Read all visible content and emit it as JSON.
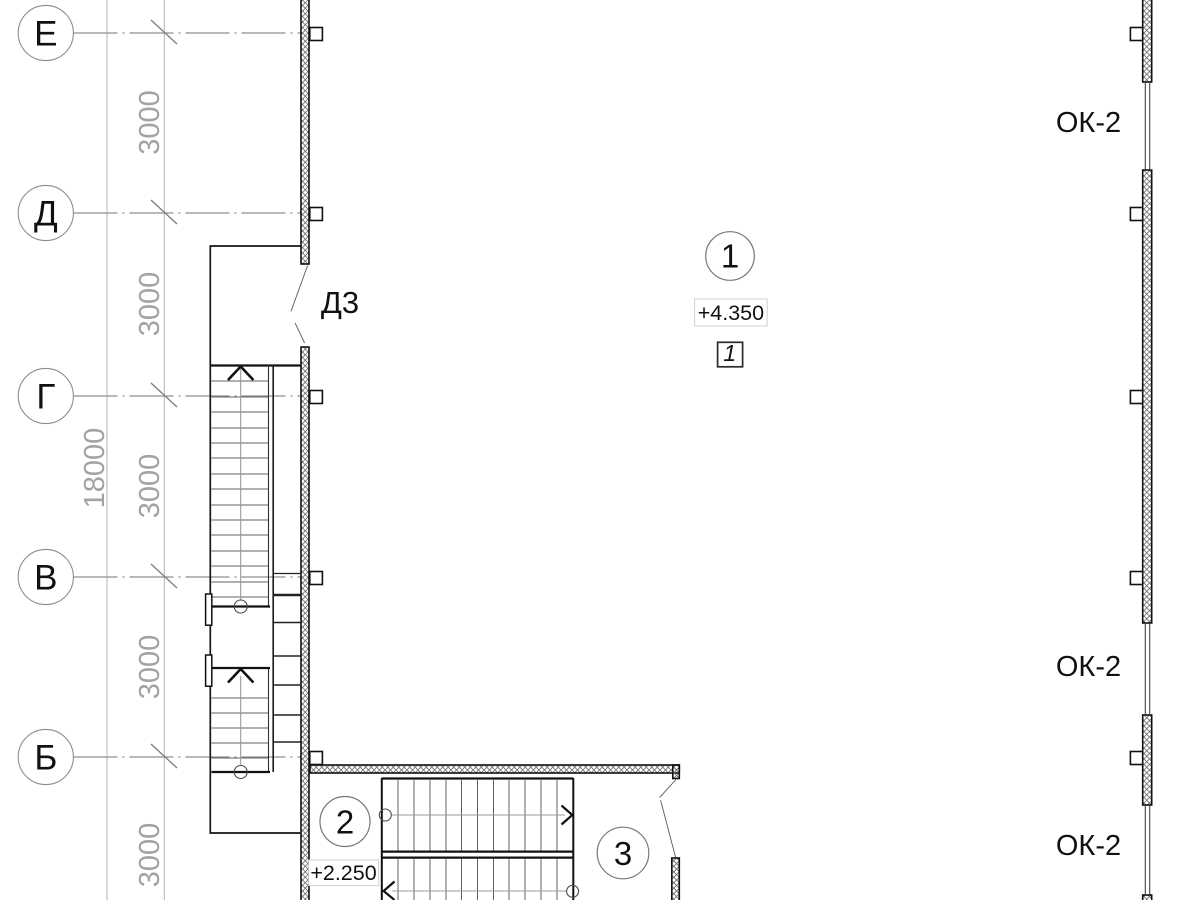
{
  "colors": {
    "ink": "#1a1a1a",
    "grid_gray": "#8f8f8f",
    "dim_gray": "#a3a3a3",
    "hatch_gray": "#6e6e6e",
    "background": "#ffffff"
  },
  "axis_labels": [
    "Е",
    "Д",
    "Г",
    "В",
    "Б"
  ],
  "dim_segments": [
    "3000",
    "3000",
    "3000",
    "3000",
    "3000"
  ],
  "dim_total": "18000",
  "door_label": "Д3",
  "window_labels": [
    "ОК-2",
    "ОК-2",
    "ОК-2"
  ],
  "levels": {
    "upper": "+4.350",
    "lower": "+2.250"
  },
  "callouts": [
    "1",
    "2",
    "3"
  ],
  "section_ref": "1"
}
